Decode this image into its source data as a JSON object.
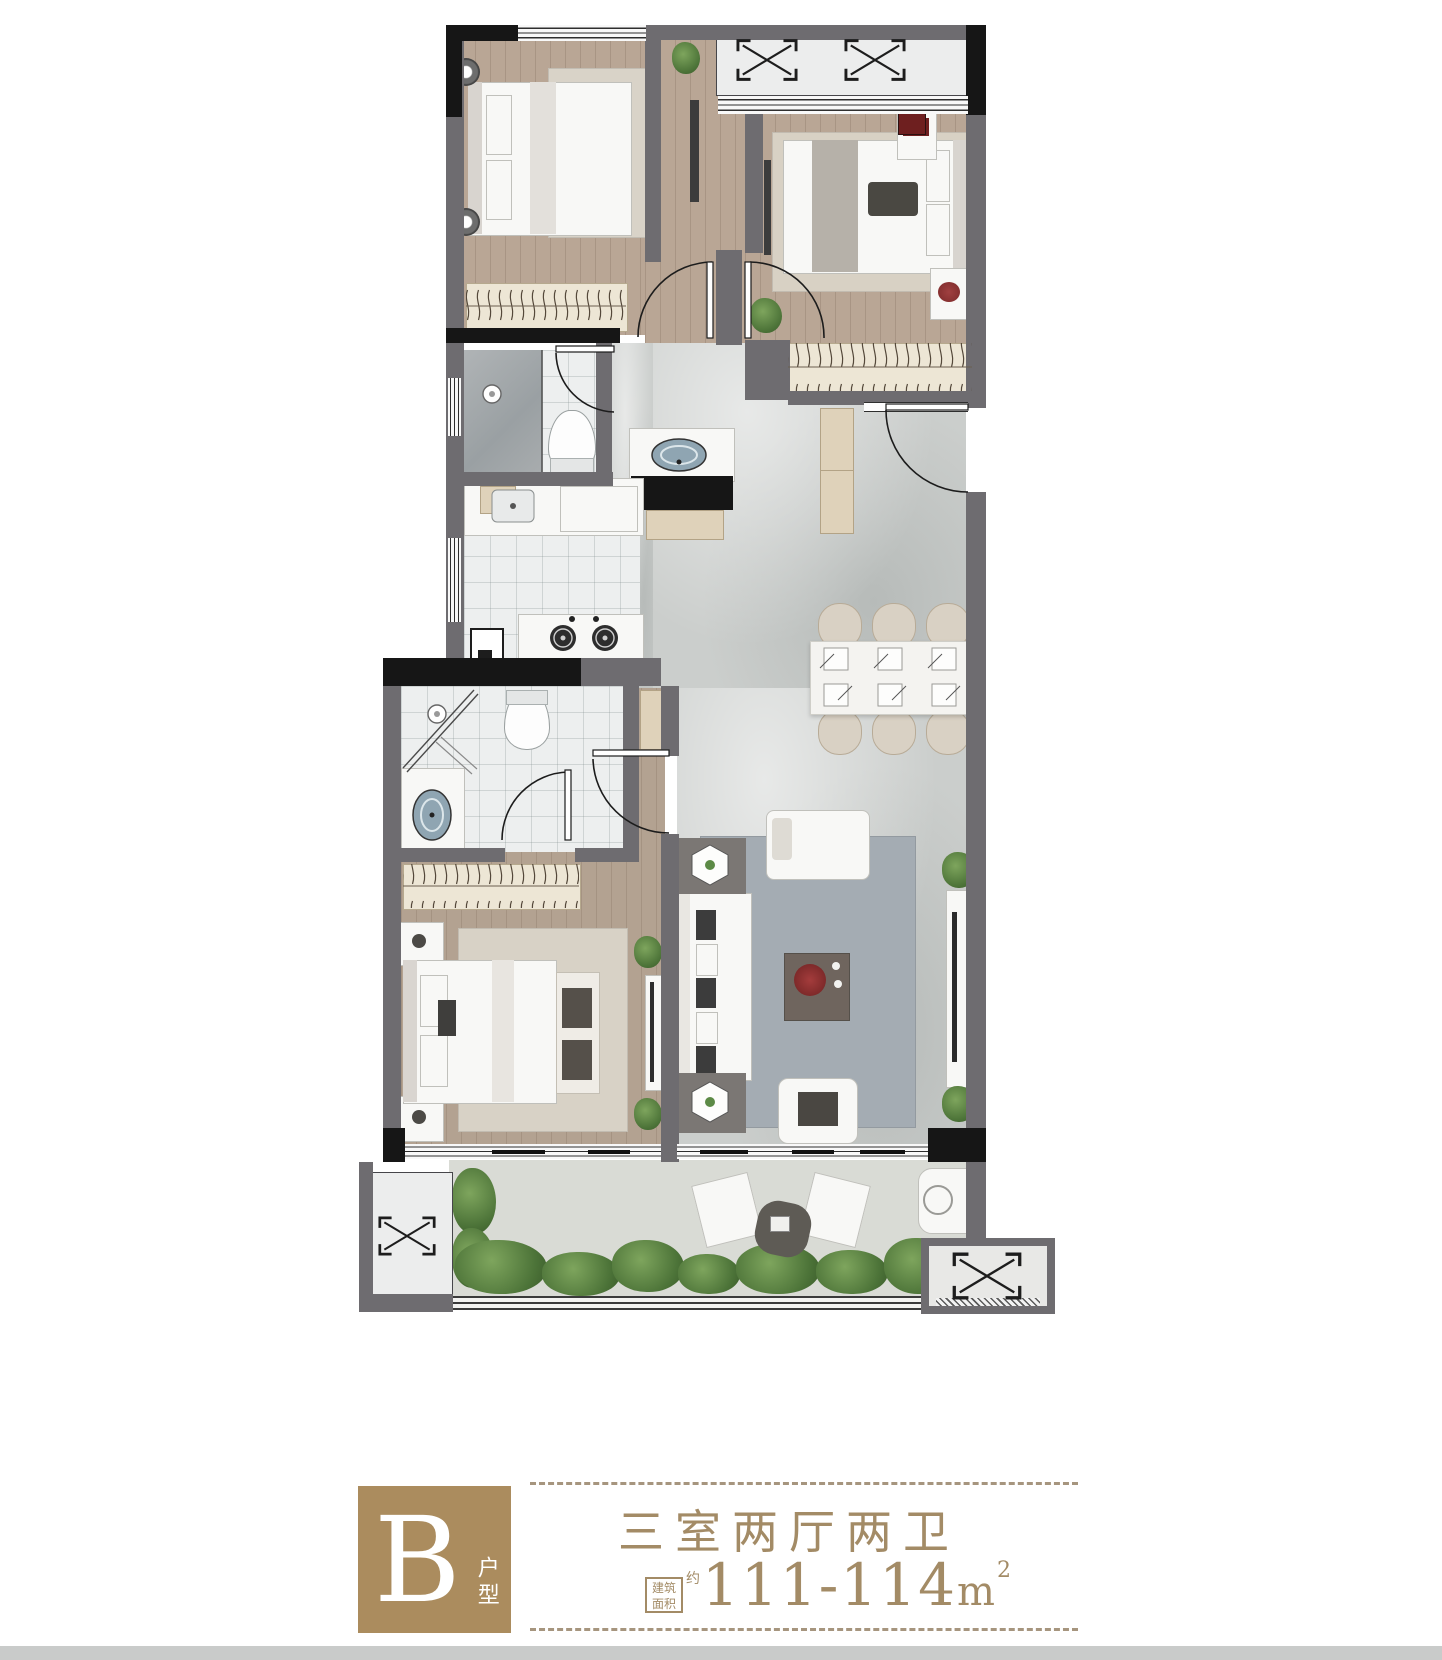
{
  "label_section": {
    "unit_letter": "B",
    "unit_suffix": "户型",
    "layout_title": "三室两厅两卫",
    "area_box_line1": "建筑",
    "area_box_line2": "面积",
    "area_approx": "约",
    "area_range": "111-114",
    "area_unit": "m",
    "area_unit_sup": "2"
  },
  "symbols": {
    "ac_unit_icon": "boxed X (outdoor AC / equipment platform)",
    "wardrobe_icon": "rail with hanger hooks",
    "door_icon": "quarter-circle swing arc",
    "window_icon": "triple parallel lines"
  },
  "colors": {
    "badge_bg": "#AB8C5E",
    "accent_text": "#A38B66",
    "dash_line": "#A6957E",
    "wall_gray": "#6E6C70",
    "wall_black": "#161616",
    "wood_floor": "#B9A695",
    "marble_floor": "#CBCECC",
    "tile_floor": "#EDEFEF",
    "wardrobe_fill": "#EDE6D5",
    "cabinet_fill": "#DFD2BA",
    "balcony_floor": "#D9DBD5",
    "plant_green": "#5C8A46",
    "living_rug": "#A4ACB3"
  }
}
